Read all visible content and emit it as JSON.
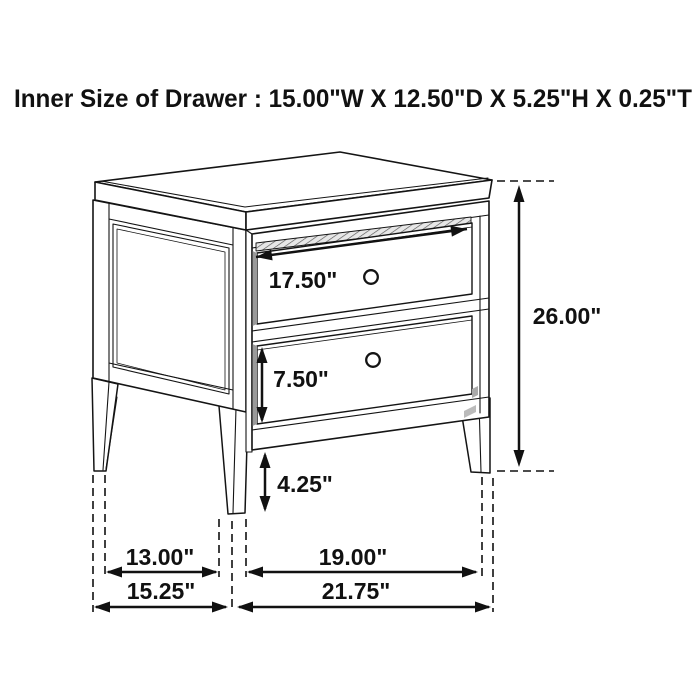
{
  "title": "Inner Size of Drawer : 15.00\"W X 12.50\"D X 5.25\"H X 0.25\"T",
  "drawing": {
    "description": "2-drawer nightstand line drawing with dimension arrows",
    "line_color": "#141414",
    "background": "#ffffff"
  },
  "labels": {
    "drawer_width": "17.50\"",
    "lower_drawer_height": "7.50\"",
    "leg_height": "4.25\"",
    "overall_height": "26.00\"",
    "leg_span_depth": "13.00\"",
    "leg_span_width": "19.00\"",
    "overall_depth": "15.25\"",
    "overall_width": "21.75\""
  }
}
